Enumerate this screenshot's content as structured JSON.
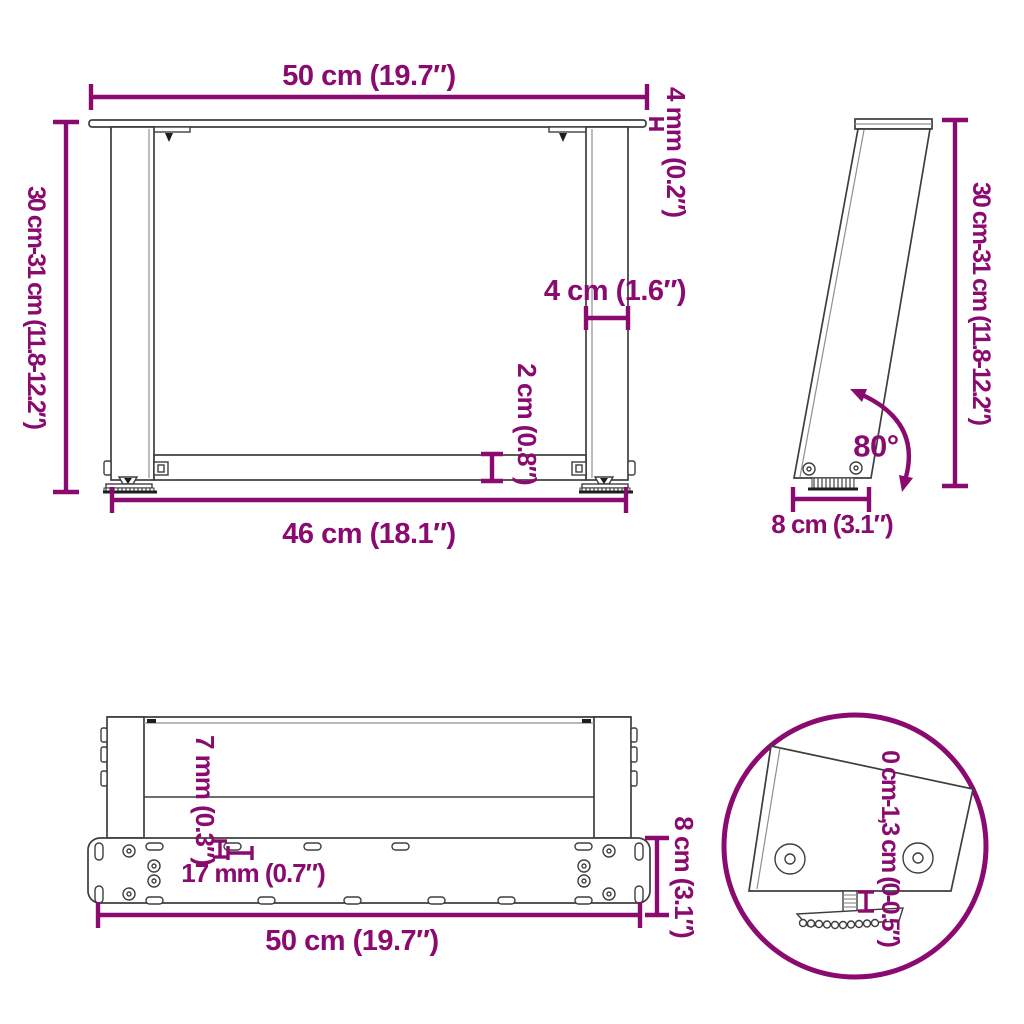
{
  "image_type": "product-dimension-diagram",
  "subject": "U-shaped table leg frame",
  "colors": {
    "dimension_accent": "#8A0A70",
    "structure_line": "#3E3E3E",
    "background": "#FFFFFF"
  },
  "views": {
    "front": {
      "labels": {
        "top_width": "50 cm (19.7″)",
        "top_thickness": "4 mm (0.2″)",
        "height": "30 cm-31 cm (11.8-12.2″)",
        "leg_width": "4 cm (1.6″)",
        "crossbar_height": "2 cm (0.8″)",
        "bottom_width": "46 cm (18.1″)"
      }
    },
    "side": {
      "labels": {
        "height": "30 cm-31 cm (11.8-12.2″)",
        "angle": "80°",
        "base_depth": "8 cm (3.1″)"
      }
    },
    "top": {
      "labels": {
        "hole_width": "7 mm (0.3″)",
        "hole_length": "17 mm (0.7″)",
        "plate_depth": "8 cm (3.1″)",
        "plate_width": "50 cm (19.7″)"
      }
    },
    "detail": {
      "labels": {
        "adjustable_range": "0 cm-1,3 cm (0-0.5″)"
      }
    }
  }
}
